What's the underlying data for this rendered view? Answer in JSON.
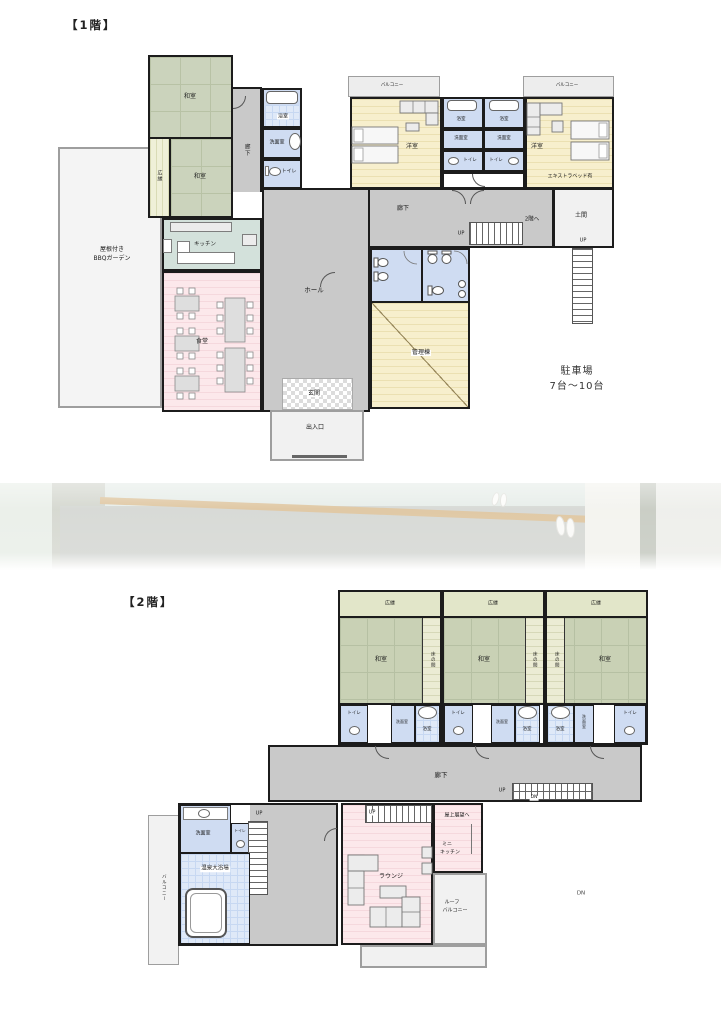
{
  "floor1": {
    "title": "【1階】",
    "garden": {
      "line1": "屋根付き",
      "line2": "BBQガーデン"
    },
    "rooms": {
      "washitsu_a": "和室",
      "washitsu_b": "和室",
      "hiroen": "広縁",
      "corridor_left": "廊下",
      "bath_left": "浴室",
      "senmen_left": "洗面室",
      "toilet_left": "トイレ",
      "kitchen": "キッチン",
      "dining": "食堂",
      "hall": "ホール",
      "genkan": "玄関",
      "entrance_porch": "出入口",
      "corridor_top": "廊下",
      "doma": "土間",
      "kanri": "管理棟"
    },
    "bedroom_left": {
      "balcony": "バルコニー",
      "name": "洋室",
      "bath": "浴室",
      "senmen": "洗面室",
      "toilet": "トイレ"
    },
    "bedroom_right": {
      "balcony": "バルコニー",
      "name": "洋室",
      "bath": "浴室",
      "senmen": "洗面室",
      "toilet": "トイレ",
      "extra_bed": "エキストラベッド有"
    },
    "stairs": {
      "up_main": "UP",
      "to_2f": "2階へ",
      "up_doma": "UP"
    },
    "parking": {
      "line1": "駐車場",
      "line2": "7台～10台"
    }
  },
  "floor2": {
    "title": "【2階】",
    "units": [
      {
        "hiroen": "広縁",
        "washitsu": "和室",
        "tokonoma": "床の間",
        "toilet": "トイレ",
        "senmen": "洗面室",
        "bath": "浴室"
      },
      {
        "hiroen": "広縁",
        "washitsu": "和室",
        "tokonoma": "床の間",
        "toilet": "トイレ",
        "senmen": "洗面室",
        "bath": "浴室"
      },
      {
        "hiroen": "広縁",
        "washitsu": "和室",
        "tokonoma": "床の間",
        "toilet": "トイレ",
        "senmen": "洗面室",
        "bath": "浴室"
      }
    ],
    "corridor": "廊下",
    "stairs": {
      "up": "UP",
      "dn": "DN"
    },
    "left_wing": {
      "balcony": "バルコニー",
      "senmen": "洗面室",
      "toilet": "トイレ",
      "up": "UP",
      "onsen_bath": "温泉大浴場"
    },
    "lounge": {
      "name": "ラウンジ",
      "up": "UP",
      "rooftop": "屋上展望へ",
      "minikitchen_line1": "ミニ",
      "minikitchen_line2": "キッチン"
    },
    "roof_balcony": {
      "line1": "ルーフ",
      "line2": "バルコニー"
    },
    "dn_outside": "DN"
  },
  "colors": {
    "wall": "#1c1c1c",
    "tatami": "#cbd3bc",
    "bedroom_yellow": "#f7efcd",
    "wet_blue": "#cfdcf2",
    "dining_pink": "#fce8eb",
    "corridor_gray": "#c9c9c9"
  }
}
